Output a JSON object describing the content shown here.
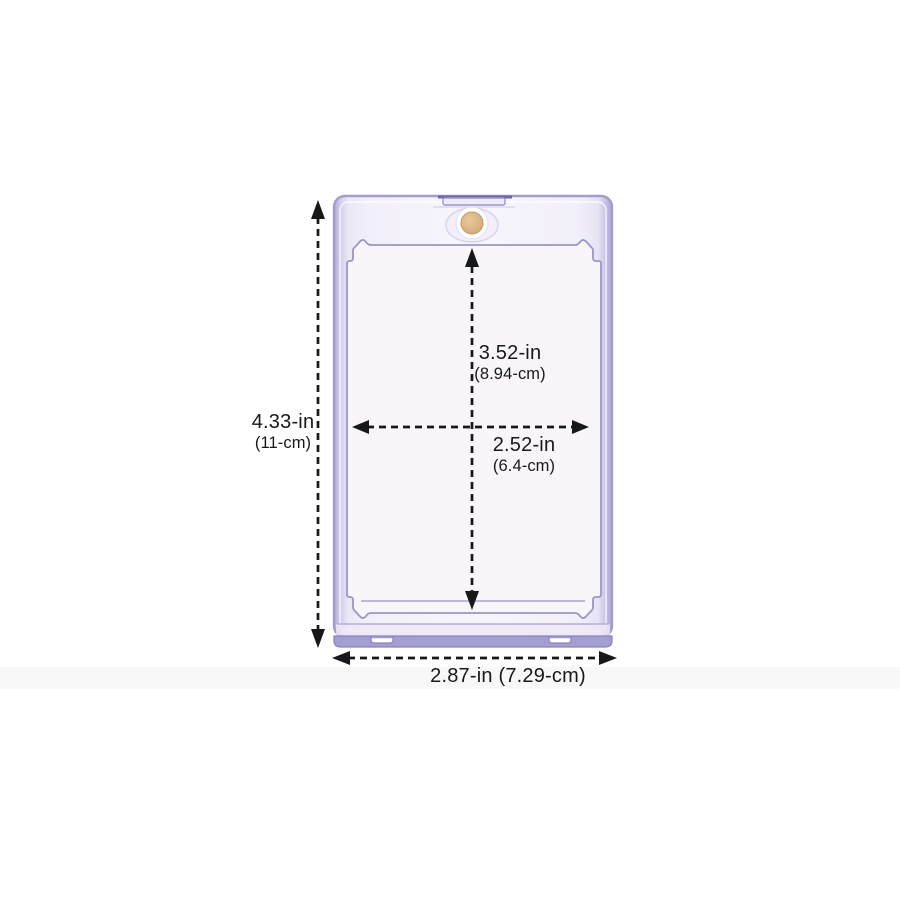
{
  "diagram": {
    "name": "card-holder-dimension-diagram",
    "product_name": "magnetic-one-touch-card-holder",
    "colors": {
      "background": "#ffffff",
      "dimension_line": "#18181b",
      "shell_edge": "#aba4d6",
      "shell_face": "#f4f1fa",
      "recess_outline": "#9c95c8",
      "magnet_gold": "#d6b080",
      "feet_strip": "#a59ed2"
    },
    "dimensions": {
      "outer_height": {
        "inches": "4.33-in",
        "metric": "(11-cm)"
      },
      "inner_height": {
        "inches": "3.52-in",
        "metric": "(8.94-cm)"
      },
      "inner_width": {
        "inches": "2.52-in",
        "metric": "(6.4-cm)"
      },
      "outer_width": {
        "label": "2.87-in (7.29-cm)"
      }
    }
  }
}
